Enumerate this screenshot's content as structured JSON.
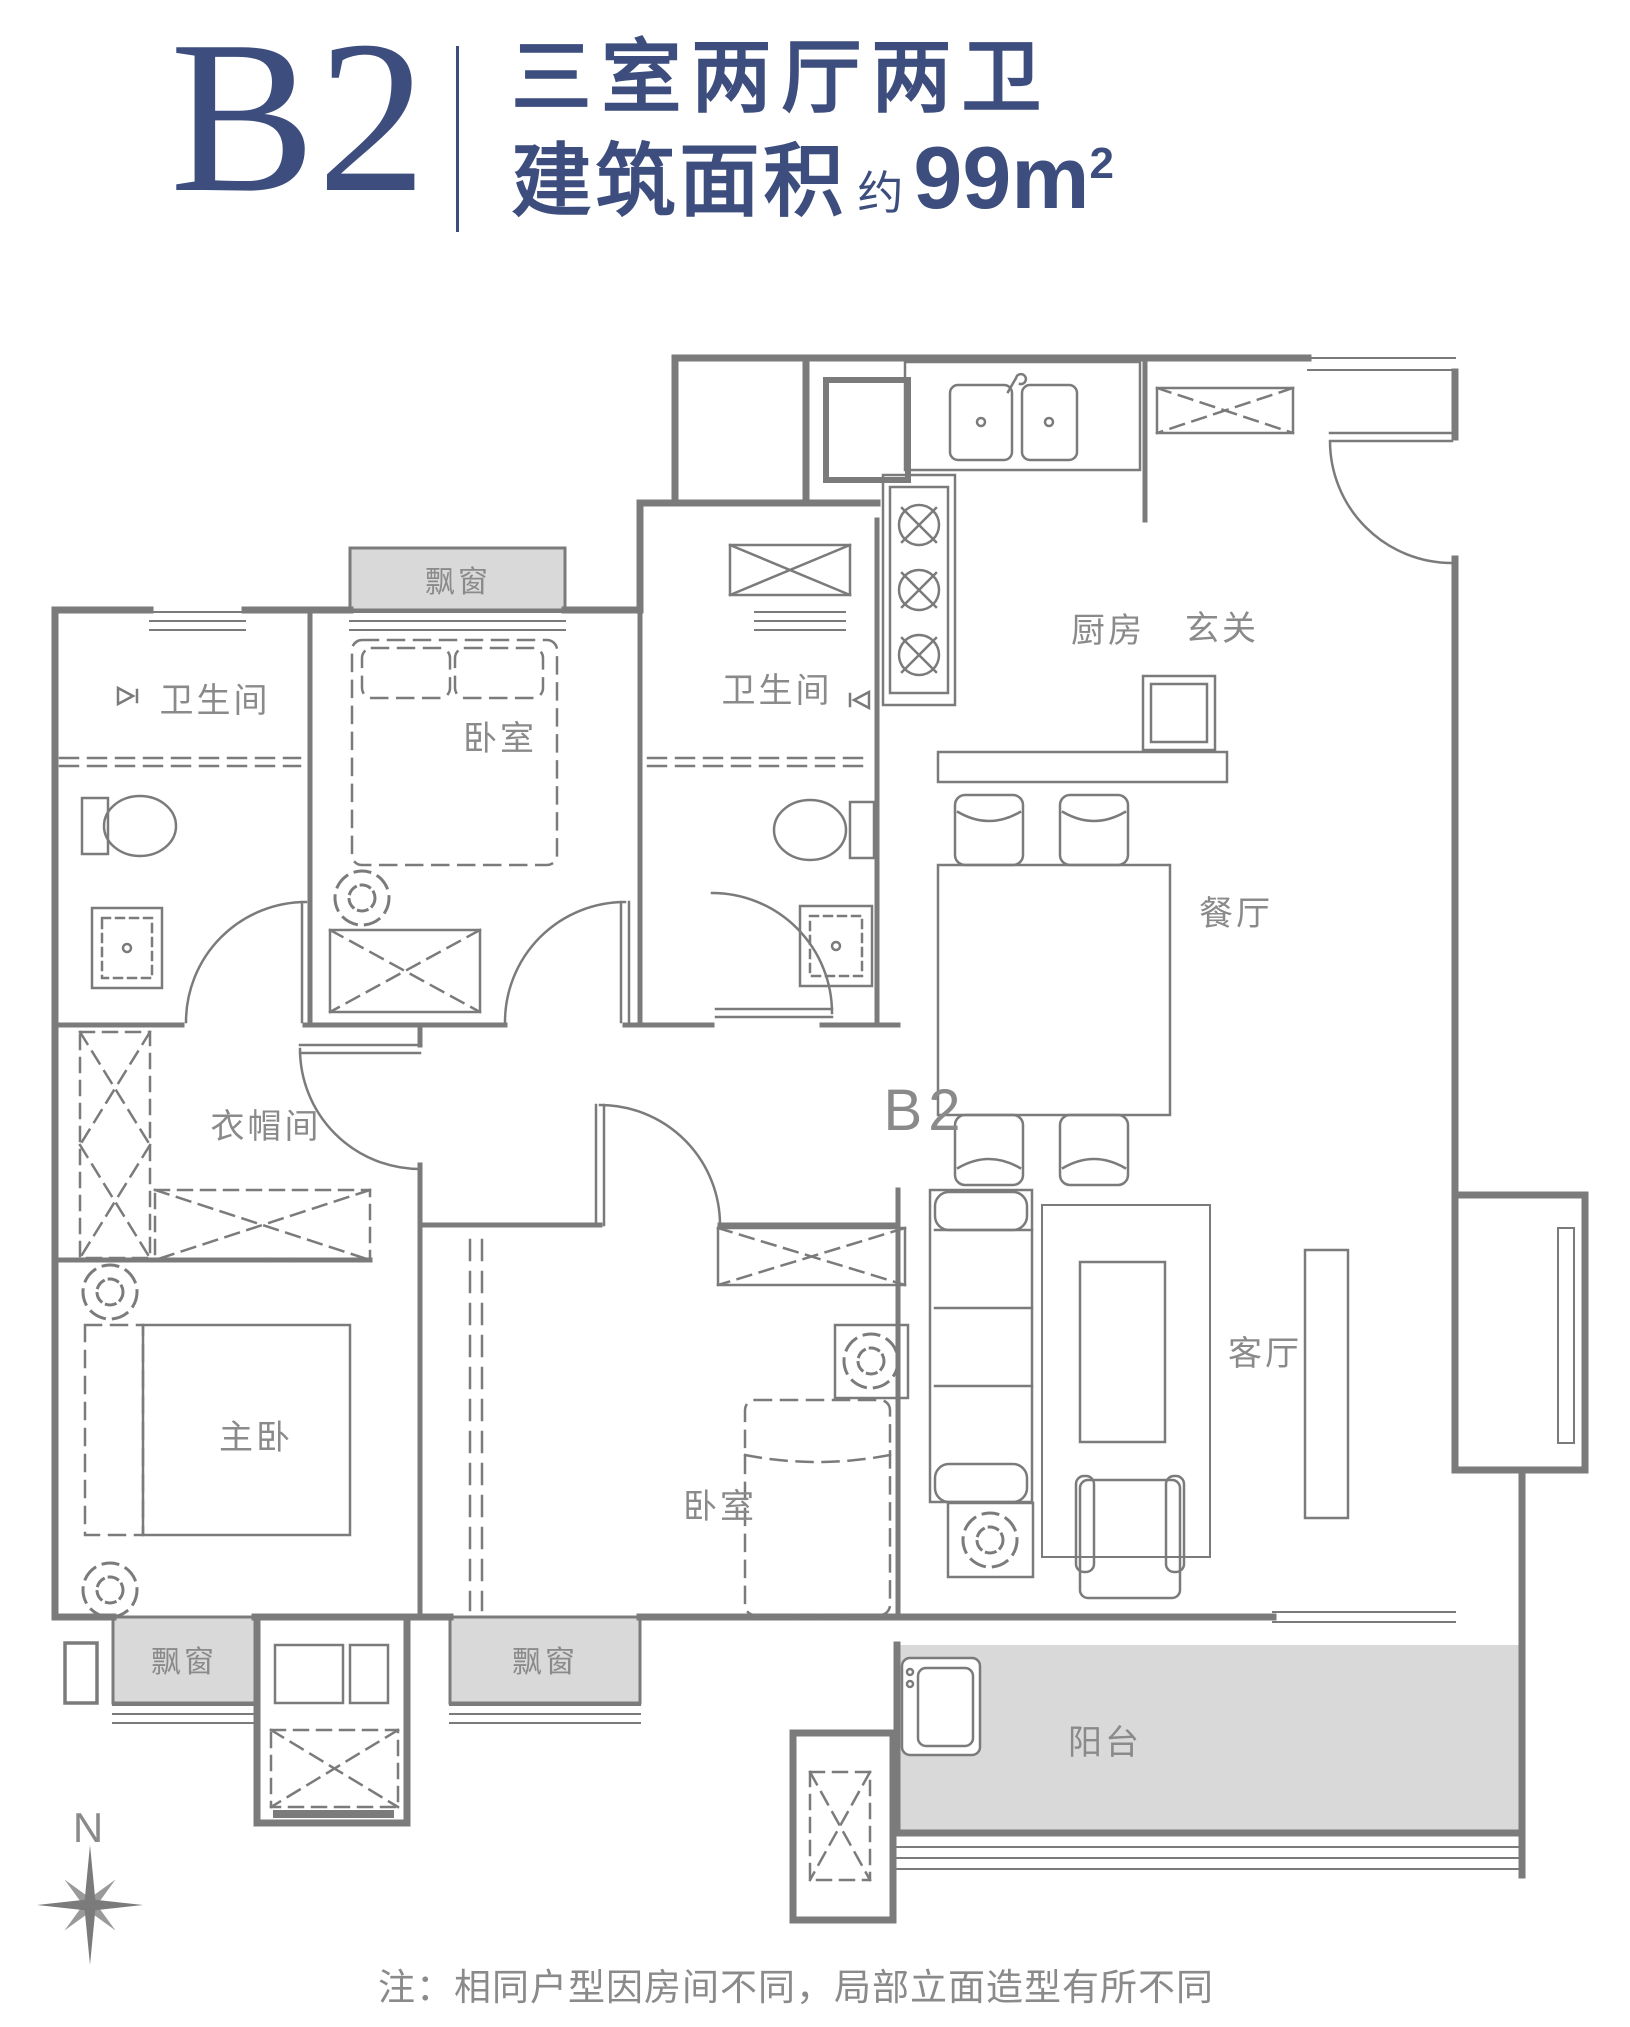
{
  "header": {
    "unit": "B2",
    "layout": "三室两厅两卫",
    "area_label": "建筑面积",
    "area_approx": "约",
    "area_value": "99m",
    "area_sup": "2"
  },
  "plan": {
    "mark": "B2",
    "compass": "N",
    "note": "注：相同户型因房间不同，局部立面造型有所不同",
    "rooms": [
      {
        "id": "bathroom-1",
        "label": "卫生间"
      },
      {
        "id": "bedroom-1",
        "label": "卧室"
      },
      {
        "id": "bathroom-2",
        "label": "卫生间"
      },
      {
        "id": "kitchen",
        "label": "厨房"
      },
      {
        "id": "foyer",
        "label": "玄关"
      },
      {
        "id": "dining-room",
        "label": "餐厅"
      },
      {
        "id": "cloakroom",
        "label": "衣帽间"
      },
      {
        "id": "master-bedroom",
        "label": "主卧"
      },
      {
        "id": "bedroom-2",
        "label": "卧室"
      },
      {
        "id": "living-room",
        "label": "客厅"
      },
      {
        "id": "balcony",
        "label": "阳台"
      }
    ],
    "bay_windows": [
      {
        "label": "飘窗"
      },
      {
        "label": "飘窗"
      },
      {
        "label": "飘窗"
      }
    ]
  },
  "colors": {
    "accent": "#3d4e7e",
    "line": "#7b7b7b",
    "area_fill": "#d9d9d9",
    "label": "#8a8a8a"
  }
}
